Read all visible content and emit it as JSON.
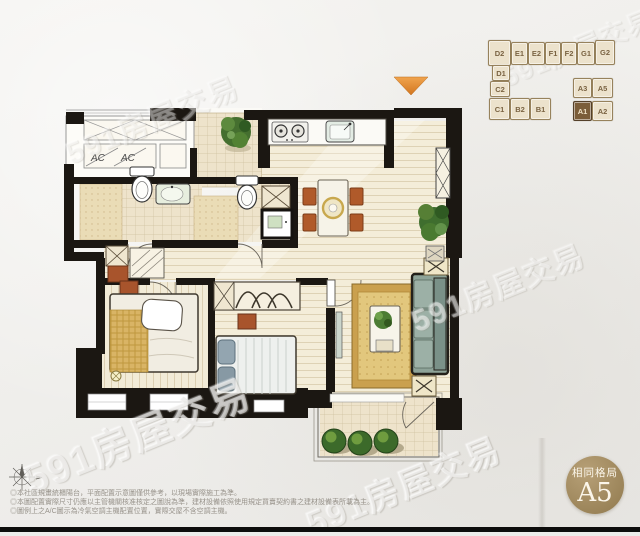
{
  "watermark": {
    "text": "591房屋交易"
  },
  "key_plan": {
    "highlighted_unit": "A1",
    "units": [
      {
        "label": "D2"
      },
      {
        "label": "E1"
      },
      {
        "label": "E2"
      },
      {
        "label": "F1"
      },
      {
        "label": "F2"
      },
      {
        "label": "G1"
      },
      {
        "label": "G2"
      },
      {
        "label": "D1"
      },
      {
        "label": "C2"
      },
      {
        "label": "A3"
      },
      {
        "label": "A5"
      },
      {
        "label": "C1"
      },
      {
        "label": "B2"
      },
      {
        "label": "B1"
      },
      {
        "label": "A1"
      },
      {
        "label": "A2"
      }
    ]
  },
  "floor_plan": {
    "ac_label": "AC"
  },
  "entrance_marker": {
    "color": "#df8a31"
  },
  "badge": {
    "title": "相同格局",
    "unit": "A5",
    "color": "#a28b60"
  },
  "disclaimer": {
    "lines": [
      "◎本社區規畫統櫃陽台，平面配置示意圖僅供參考，以現場實際施工為準。",
      "◎本圖配置實際尺寸仍應以主管機關核准核定之圖說為準，建材設備依照使用規定買賣契約書之建材設備表所載為主。",
      "◎圖例上之A/C圖示為冷氣空調主機配置位置，實際交屋不含空調主機。"
    ]
  }
}
